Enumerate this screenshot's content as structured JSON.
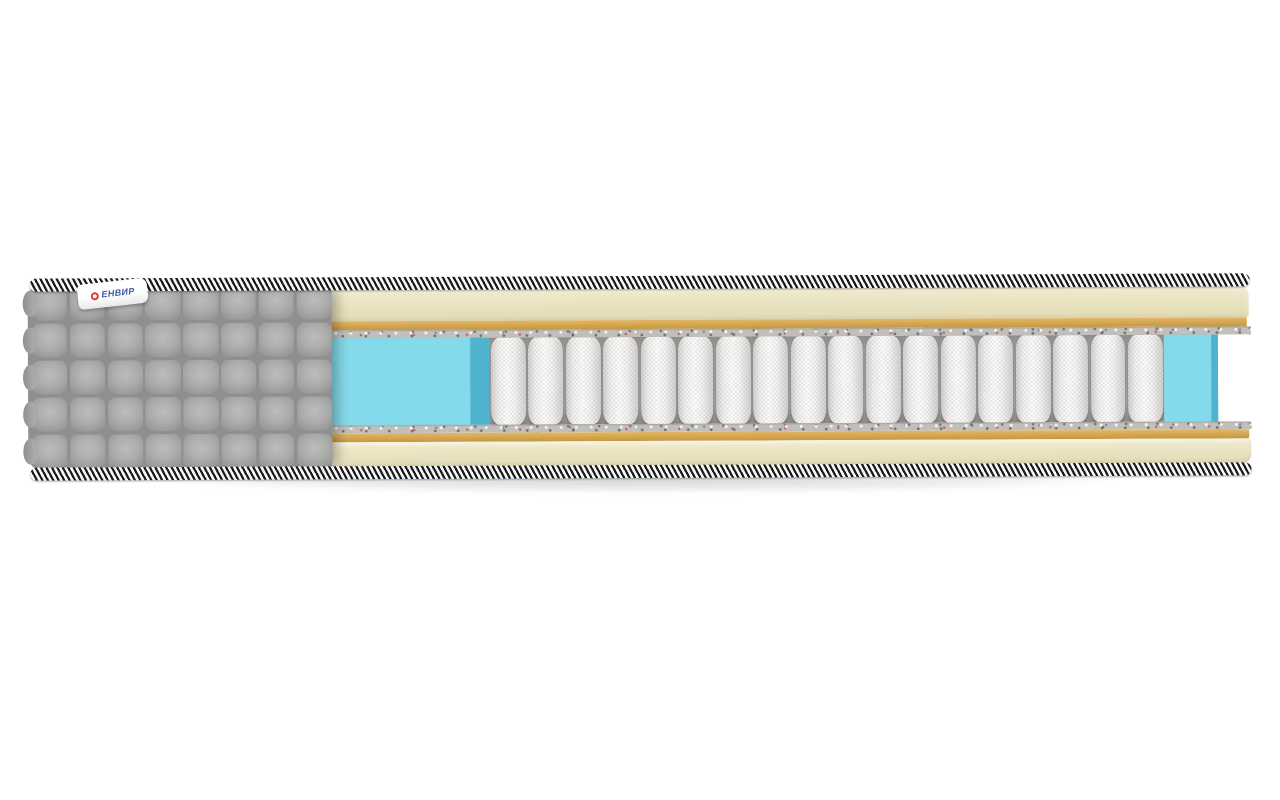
{
  "meta": {
    "description": "Product photo: side cutaway view of a pocket-spring mattress",
    "background": "#ffffff"
  },
  "brand_tag": {
    "text": "ЕНВИР",
    "text_color": "#3a57a8",
    "logo_color": "#e03a2f",
    "tag_bg": "#ffffff"
  },
  "colors": {
    "page_bg": "#ffffff",
    "fabric": "#a9a9a7",
    "fabric_gap": "#8f908e",
    "piping_dark": "#191919",
    "piping_light": "#f6f6f6",
    "foam_cream_light": "#f0eacd",
    "foam_cream_dark": "#e4dcb6",
    "foam_tan_light": "#e2b766",
    "foam_tan_dark": "#c5973f",
    "felt_base": "#c2bfbb",
    "spring_white": "#fdfdfc",
    "spring_shade": "#d2d1cf",
    "cavity": "#989694",
    "perimeter_foam": "#84d9ea",
    "perimeter_foam_edge": "#4fb3cd",
    "brand_blue": "#3a57a8",
    "logo_red": "#e03a2f"
  },
  "structure": {
    "spring_count": 18,
    "quilt_rows": 5,
    "quilt_cols": 8,
    "layers_top_to_bottom": [
      "piping-cord",
      "quilted-cover / cream-foam",
      "tan-foam-layer",
      "felt-layer",
      "perimeter-foam + pocket-springs",
      "felt-layer",
      "tan-foam-layer",
      "cream-foam",
      "piping-cord"
    ]
  }
}
